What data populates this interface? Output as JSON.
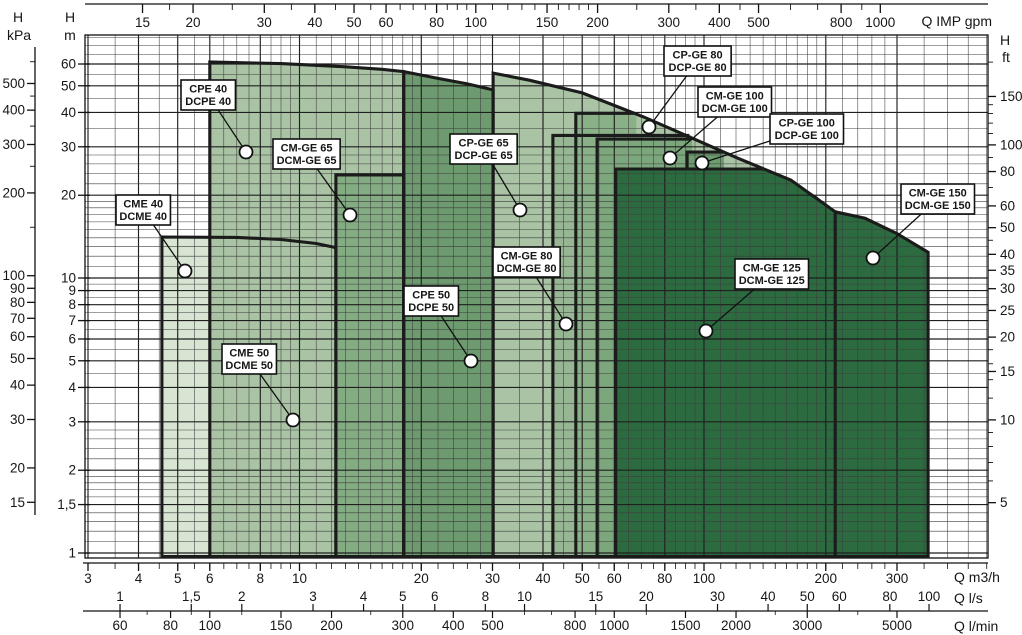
{
  "chart_data": {
    "type": "area",
    "title": "Pump series coverage chart (Q-H, log-log)",
    "grid": "log-log minor grid on",
    "xlim_m3h": [
      2.9,
      505
    ],
    "ylim_m": [
      0.97,
      76.2
    ],
    "axes": {
      "top_gpm": {
        "title": "Q IMP gpm",
        "factor_to_m3h": 0.2728,
        "tick_labels": [
          "15",
          "20",
          "30",
          "40",
          "50",
          "60",
          "80",
          "100",
          "150",
          "200",
          "300",
          "400",
          "500",
          "800",
          "1000"
        ],
        "tick_values": [
          15,
          20,
          30,
          40,
          50,
          60,
          80,
          100,
          150,
          200,
          300,
          400,
          500,
          800,
          1000
        ],
        "minor_values": [
          17.5,
          25,
          35,
          45,
          55,
          65,
          70,
          75,
          85,
          90,
          95,
          110,
          120,
          130,
          140,
          160,
          170,
          180,
          190,
          250,
          350,
          450,
          600,
          700,
          900
        ]
      },
      "bottom_m3h": {
        "title": "Q m3/h",
        "tick_labels": [
          "3",
          "4",
          "5",
          "6",
          "8",
          "10",
          "20",
          "30",
          "40",
          "50",
          "60",
          "80",
          "100",
          "200",
          "300"
        ],
        "tick_values": [
          3,
          4,
          5,
          6,
          8,
          10,
          20,
          30,
          40,
          50,
          60,
          80,
          100,
          200,
          300
        ]
      },
      "bottom_ls": {
        "title": "Q l/s",
        "factor_to_m3h": 3.6,
        "tick_labels": [
          "1",
          "1,5",
          "2",
          "3",
          "4",
          "5",
          "6",
          "8",
          "10",
          "15",
          "20",
          "30",
          "40",
          "50",
          "60",
          "80",
          "100"
        ],
        "tick_values": [
          1,
          1.5,
          2,
          3,
          4,
          5,
          6,
          8,
          10,
          15,
          20,
          30,
          40,
          50,
          60,
          80,
          100
        ]
      },
      "bottom_lmin": {
        "title": "Q l/min",
        "factor_to_m3h": 0.06,
        "tick_labels": [
          "60",
          "80",
          "100",
          "150",
          "200",
          "300",
          "400",
          "500",
          "800",
          "1000",
          "1500",
          "2000",
          "3000",
          "5000"
        ],
        "tick_values": [
          60,
          80,
          100,
          150,
          200,
          300,
          400,
          500,
          800,
          1000,
          1500,
          2000,
          3000,
          5000
        ],
        "minor_values": [
          70,
          90,
          120,
          250,
          600,
          700,
          900,
          1200,
          2500,
          4000
        ]
      },
      "left_m": {
        "title_line1": "H",
        "title_line2": "m",
        "tick_labels": [
          "60",
          "50",
          "40",
          "30",
          "20",
          "10",
          "9",
          "8",
          "7",
          "6",
          "5",
          "4",
          "3",
          "2",
          "1,5",
          "1"
        ],
        "tick_values": [
          60,
          50,
          40,
          30,
          20,
          10,
          9,
          8,
          7,
          6,
          5,
          4,
          3,
          2,
          1.5,
          1
        ]
      },
      "left_kpa": {
        "title_line1": "H",
        "title_line2": "kPa",
        "factor_to_m": 0.10194,
        "tick_labels": [
          "500",
          "400",
          "300",
          "200",
          "100",
          "90",
          "80",
          "70",
          "60",
          "50",
          "40",
          "30",
          "20",
          "15"
        ],
        "tick_values": [
          500,
          400,
          300,
          200,
          100,
          90,
          80,
          70,
          60,
          50,
          40,
          30,
          20,
          15
        ],
        "minor_values": [
          150,
          250,
          350,
          450,
          600
        ]
      },
      "right_ft": {
        "title_line1": "H",
        "title_line2": "ft",
        "factor_to_m": 0.3048,
        "tick_labels": [
          "150",
          "100",
          "80",
          "60",
          "50",
          "40",
          "35",
          "30",
          "25",
          "20",
          "15",
          "10",
          "5"
        ],
        "tick_values": [
          150,
          100,
          80,
          60,
          50,
          40,
          35,
          30,
          25,
          20,
          15,
          10,
          5
        ],
        "minor_values": [
          6,
          7,
          8,
          9,
          12,
          14,
          16,
          18,
          45,
          70,
          90,
          110,
          120,
          130,
          140,
          200
        ]
      }
    },
    "colors": {
      "region_border": "#1b1b1b",
      "grid_minor": "#3c3c3c",
      "grid_major": "#1f1f1f",
      "callout_bg": "#ffffff",
      "dark_green": "#2c6b40",
      "light_green": "#a9c3a4",
      "palest_green": "#d8e5d3"
    },
    "regions": [
      {
        "id": "cme40",
        "models": [
          "CME 40",
          "DCME 40"
        ],
        "fill": "#d8e5d3",
        "closed": true,
        "area": [
          [
            4.57,
            0.97
          ],
          [
            4.57,
            14.1
          ],
          [
            7,
            14.05
          ],
          [
            9,
            13.8
          ],
          [
            11,
            13.35
          ],
          [
            12.3,
            12.9
          ],
          [
            12.3,
            0.97
          ]
        ]
      },
      {
        "id": "cpe40",
        "models": [
          "CPE 40",
          "DCPE 40"
        ],
        "fill": "#a9c3a4",
        "closed": true,
        "area": [
          [
            6,
            0.97
          ],
          [
            6,
            61
          ],
          [
            9,
            60.2
          ],
          [
            13,
            58.6
          ],
          [
            16,
            57.4
          ],
          [
            18.1,
            56.3
          ],
          [
            18.1,
            0.97
          ]
        ]
      },
      {
        "id": "cmge65",
        "models": [
          "CM-GE 65",
          "DCM-GE 65"
        ],
        "fill": "#84ac83",
        "closed": true,
        "area": [
          [
            12.3,
            0.97
          ],
          [
            12.3,
            23.7
          ],
          [
            18.1,
            23.7
          ],
          [
            18.1,
            0.97
          ]
        ]
      },
      {
        "id": "cpe50",
        "models": [
          "CPE 50",
          "DCPE 50"
        ],
        "fill": "#6d9a6f",
        "closed": true,
        "area": [
          [
            18.1,
            0.97
          ],
          [
            18.1,
            56.3
          ],
          [
            22,
            53.2
          ],
          [
            26,
            50.8
          ],
          [
            30.1,
            48.3
          ],
          [
            30.1,
            0.97
          ]
        ]
      },
      {
        "id": "cpge65",
        "models": [
          "CP-GE 65",
          "DCP-GE 65"
        ],
        "fill": "#a9c3a4",
        "closed": true,
        "area": [
          [
            30.1,
            0.97
          ],
          [
            30.1,
            55.6
          ],
          [
            37,
            52.4
          ],
          [
            50,
            47.1
          ],
          [
            71,
            38.5
          ],
          [
            92,
            32.6
          ],
          [
            121,
            27.3
          ],
          [
            164,
            22.7
          ],
          [
            211,
            17.4
          ],
          [
            211,
            0.97
          ]
        ]
      },
      {
        "id": "cmge80",
        "models": [
          "CM-GE 80",
          "DCM-GE 80"
        ],
        "fill": "#97b794",
        "closed": false,
        "area": [
          [
            42.3,
            0.97
          ],
          [
            42.3,
            33
          ],
          [
            93,
            33
          ],
          [
            93,
            0.97
          ]
        ],
        "border": [
          [
            42.3,
            0.97
          ],
          [
            42.3,
            33
          ],
          [
            92,
            33
          ]
        ]
      },
      {
        "id": "cpge80",
        "models": [
          "CP-GE 80",
          "DCP-GE 80"
        ],
        "fill": "#89b087",
        "closed": false,
        "area": [
          [
            48.2,
            0.97
          ],
          [
            48.2,
            39.7
          ],
          [
            68,
            39.7
          ],
          [
            68,
            0.97
          ]
        ],
        "border": [
          [
            48.2,
            0.97
          ],
          [
            48.2,
            39.7
          ],
          [
            67,
            39.7
          ]
        ]
      },
      {
        "id": "cmge100",
        "models": [
          "CM-GE 100",
          "DCM-GE 100"
        ],
        "fill": "#7ca77c",
        "closed": false,
        "area": [
          [
            54.4,
            0.97
          ],
          [
            54.4,
            32
          ],
          [
            93.5,
            32
          ],
          [
            93.5,
            0.97
          ]
        ],
        "border": [
          [
            54.4,
            0.97
          ],
          [
            54.4,
            32
          ],
          [
            93,
            32
          ]
        ]
      },
      {
        "id": "cpge100",
        "models": [
          "CP-GE 100",
          "DCP-GE 100"
        ],
        "fill": "#6d9c6f",
        "closed": false,
        "area": [
          [
            90.8,
            0.97
          ],
          [
            90.8,
            28.7
          ],
          [
            112,
            28.7
          ],
          [
            112,
            0.97
          ]
        ],
        "border": [
          [
            90.8,
            24.9
          ],
          [
            90.8,
            28.7
          ],
          [
            111.5,
            28.7
          ]
        ]
      },
      {
        "id": "cmge125",
        "models": [
          "CM-GE 125",
          "DCM-GE 125"
        ],
        "fill": "#2c6b40",
        "closed": false,
        "area": [
          [
            60.5,
            0.97
          ],
          [
            60.5,
            24.9
          ],
          [
            140,
            24.9
          ],
          [
            164,
            22.7
          ],
          [
            190,
            19.8
          ],
          [
            211,
            17.4
          ],
          [
            211,
            0.97
          ]
        ],
        "border": [
          [
            60.5,
            0.97
          ],
          [
            60.5,
            24.9
          ],
          [
            141,
            24.9
          ]
        ]
      },
      {
        "id": "cmge150",
        "models": [
          "CM-GE 150",
          "DCM-GE 150"
        ],
        "fill": "#2c6b40",
        "closed": false,
        "area": [
          [
            211,
            0.97
          ],
          [
            211,
            17.4
          ],
          [
            250,
            16.5
          ],
          [
            300,
            14.5
          ],
          [
            358,
            12.4
          ],
          [
            358,
            0.97
          ]
        ],
        "border": [
          [
            211,
            17.4
          ],
          [
            250,
            16.5
          ],
          [
            300,
            14.5
          ],
          [
            358,
            12.4
          ],
          [
            358,
            0.97
          ],
          [
            211,
            0.97
          ]
        ]
      }
    ],
    "callouts": [
      {
        "id": "cpe40",
        "line1": "CPE 40",
        "line2": "DCPE 40",
        "box": [
          181,
          80
        ],
        "marker": [
          246,
          152
        ]
      },
      {
        "id": "cmge65",
        "line1": "CM-GE 65",
        "line2": "DCM-GE 65",
        "box": [
          273,
          139
        ],
        "marker": [
          350,
          215
        ]
      },
      {
        "id": "cme40",
        "line1": "CME 40",
        "line2": "DCME 40",
        "box": [
          116,
          195
        ],
        "marker": [
          185,
          271
        ]
      },
      {
        "id": "cme50",
        "line1": "CME 50",
        "line2": "DCME 50",
        "box": [
          222,
          344
        ],
        "marker": [
          293,
          420
        ]
      },
      {
        "id": "cpe50",
        "line1": "CPE 50",
        "line2": "DCPE 50",
        "box": [
          404,
          286
        ],
        "marker": [
          471,
          361
        ]
      },
      {
        "id": "cpge65",
        "line1": "CP-GE 65",
        "line2": "DCP-GE 65",
        "box": [
          450,
          134
        ],
        "marker": [
          520,
          210
        ]
      },
      {
        "id": "cmge80",
        "line1": "CM-GE 80",
        "line2": "DCM-GE 80",
        "box": [
          493,
          247
        ],
        "marker": [
          566,
          324
        ]
      },
      {
        "id": "cpge80",
        "line1": "CP-GE 80",
        "line2": "DCP-GE 80",
        "box": [
          664,
          46
        ],
        "marker": [
          649,
          127
        ]
      },
      {
        "id": "cmge100",
        "line1": "CM-GE 100",
        "line2": "DCM-GE 100",
        "box": [
          698,
          87
        ],
        "marker": [
          670,
          158
        ]
      },
      {
        "id": "cpge100",
        "line1": "CP-GE 100",
        "line2": "DCP-GE 100",
        "box": [
          770,
          114
        ],
        "marker": [
          702,
          163
        ]
      },
      {
        "id": "cmge125",
        "line1": "CM-GE 125",
        "line2": "DCM-GE 125",
        "box": [
          735,
          259
        ],
        "marker": [
          706,
          331
        ]
      },
      {
        "id": "cmge150",
        "line1": "CM-GE 150",
        "line2": "DCM-GE 150",
        "box": [
          901,
          184
        ],
        "marker": [
          873,
          258
        ]
      }
    ]
  }
}
